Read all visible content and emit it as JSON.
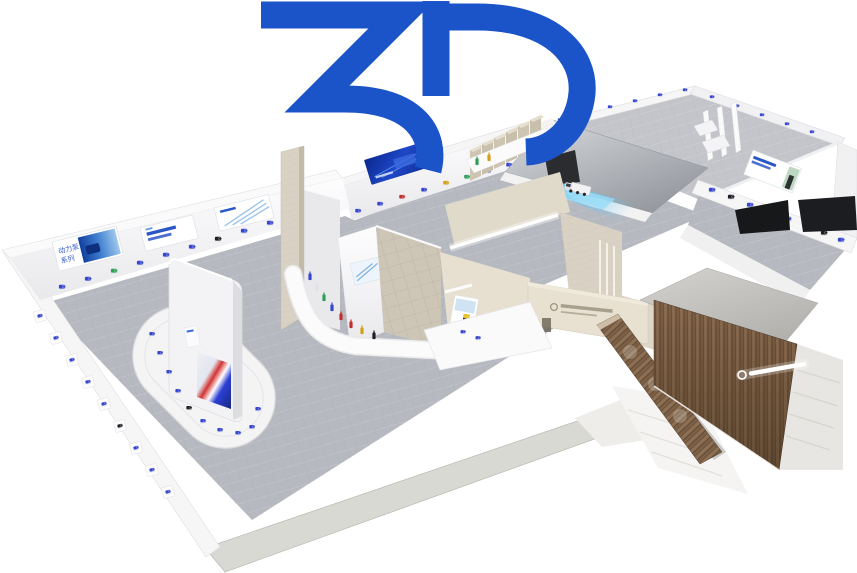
{
  "logo": {
    "text": "3D",
    "color": "#1b53c8"
  },
  "banners": {
    "power_pump_series": {
      "line1": "动力泵",
      "line2": "系列"
    }
  },
  "palette": {
    "logo_blue": "#1b53c8",
    "floor_gray": "#b5b8bf",
    "wall_white": "#f5f5f6",
    "travertine": "#d8d1c3",
    "wood_brown": "#7f6348",
    "banner_navy": "#12309e",
    "product_blue": "#3646cf",
    "product_green": "#2f9e56",
    "product_red": "#c03030",
    "product_yellow": "#d4a017",
    "screen_red": "#c8342e",
    "glow_blue": "#57c0f2",
    "rim_band": "#d8d9d2"
  },
  "scene": {
    "pumps": {
      "banner-wall": [
        [
          62,
          287,
          "#3646cf"
        ],
        [
          88,
          279,
          "#3646cf"
        ],
        [
          114,
          271,
          "#2f9e56"
        ],
        [
          140,
          263,
          "#3646cf"
        ],
        [
          166,
          255,
          "#3646cf"
        ],
        [
          192,
          247,
          "#3646cf"
        ],
        [
          218,
          239,
          "#1d1f22"
        ],
        [
          244,
          231,
          "#3646cf"
        ],
        [
          270,
          223,
          "#3646cf"
        ],
        [
          296,
          216,
          "#3646cf"
        ],
        [
          322,
          209,
          "#3646cf"
        ]
      ],
      "niche-wall": [
        [
          40,
          316,
          "#3646cf"
        ],
        [
          56,
          338,
          "#3646cf"
        ],
        [
          72,
          360,
          "#3646cf"
        ],
        [
          88,
          382,
          "#3646cf"
        ],
        [
          104,
          404,
          "#3646cf"
        ],
        [
          120,
          426,
          "#1d1f22"
        ],
        [
          136,
          448,
          "#3646cf"
        ],
        [
          152,
          470,
          "#3646cf"
        ],
        [
          168,
          492,
          "#3646cf"
        ]
      ],
      "oval-platform": [
        [
          152,
          334,
          "#3646cf"
        ],
        [
          160,
          353,
          "#3646cf"
        ],
        [
          169,
          372,
          "#3646cf"
        ],
        [
          178,
          391,
          "#3646cf"
        ],
        [
          189,
          408,
          "#1d1f22"
        ],
        [
          203,
          421,
          "#3646cf"
        ],
        [
          220,
          430,
          "#3646cf"
        ],
        [
          238,
          433,
          "#3646cf"
        ],
        [
          252,
          427,
          "#3646cf"
        ],
        [
          258,
          409,
          "#3646cf"
        ]
      ],
      "second-hall-wall": [
        [
          358,
          211,
          "#3646cf"
        ],
        [
          380,
          204,
          "#3646cf"
        ],
        [
          402,
          197,
          "#c03030"
        ],
        [
          424,
          190,
          "#3646cf"
        ],
        [
          446,
          183,
          "#d4a017"
        ],
        [
          467,
          177,
          "#2f9e56"
        ],
        [
          488,
          171,
          "#3646cf"
        ],
        [
          509,
          165,
          "#3646cf"
        ]
      ],
      "hall-rims": [
        [
          560,
          120,
          "#3646cf"
        ],
        [
          585,
          113,
          "#1d1f22"
        ],
        [
          610,
          107,
          "#3646cf"
        ],
        [
          635,
          101,
          "#3646cf"
        ],
        [
          660,
          95,
          "#3646cf"
        ],
        [
          685,
          90,
          "#3646cf"
        ],
        [
          712,
          97,
          "#3646cf"
        ],
        [
          737,
          106,
          "#3646cf"
        ],
        [
          762,
          115,
          "#3646cf"
        ],
        [
          787,
          124,
          "#3646cf"
        ],
        [
          812,
          132,
          "#3646cf"
        ]
      ],
      "right-shelf": [
        [
          712,
          190,
          "#3646cf"
        ],
        [
          731,
          197,
          "#1d1f22"
        ],
        [
          750,
          205,
          "#3646cf"
        ],
        [
          769,
          212,
          "#2f9e56"
        ],
        [
          788,
          219,
          "#3646cf"
        ],
        [
          806,
          226,
          "#3646cf"
        ],
        [
          824,
          233,
          "#1d1f22"
        ],
        [
          841,
          240,
          "#3646cf"
        ]
      ],
      "reception-front": [
        [
          463,
          332,
          "#3646cf"
        ],
        [
          478,
          338,
          "#3646cf"
        ]
      ]
    },
    "bottles": {
      "walkway": [
        [
          310,
          276,
          "#3646cf"
        ],
        [
          317,
          287,
          "#dfe2e8"
        ],
        [
          324,
          297,
          "#2f9e56"
        ],
        [
          332,
          307,
          "#3646cf"
        ],
        [
          341,
          316,
          "#c03030"
        ],
        [
          351,
          324,
          "#c03030"
        ],
        [
          362,
          330,
          "#d4a017"
        ],
        [
          374,
          335,
          "#1d1f22"
        ]
      ],
      "stairs-plinth": [
        [
          477,
          161,
          "#2f9e56"
        ],
        [
          489,
          157,
          "#d4a017"
        ]
      ]
    }
  }
}
